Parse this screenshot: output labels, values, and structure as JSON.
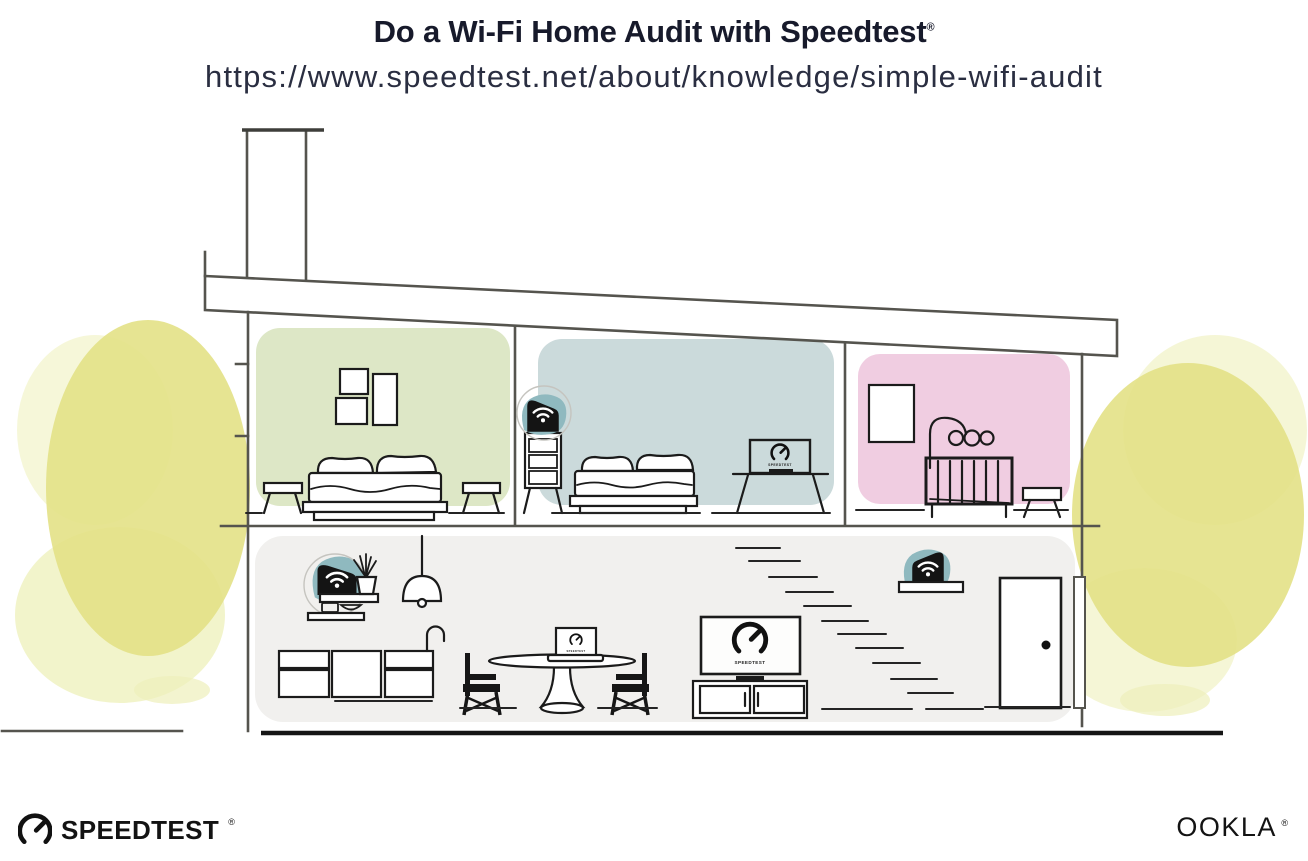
{
  "header": {
    "title": "Do a Wi-Fi Home Audit with Speedtest",
    "registered_mark": "®",
    "url": "https://www.speedtest.net/about/knowledge/simple-wifi-audit"
  },
  "branding": {
    "speedtest_wordmark": "SPEEDTEST",
    "speedtest_registered": "®",
    "ookla_wordmark": "OOKLA",
    "ookla_registered": "®"
  },
  "illustration": {
    "screen_label": "SPEEDTEST",
    "colors": {
      "room_green": "#dde7c6",
      "room_blue": "#cbdadb",
      "room_pink": "#f0cde1",
      "ground_gray": "#f1f0ee",
      "teal": "#8fb9bf",
      "tree_main": "#e3e186",
      "tree_light": "#eef0ba"
    }
  }
}
